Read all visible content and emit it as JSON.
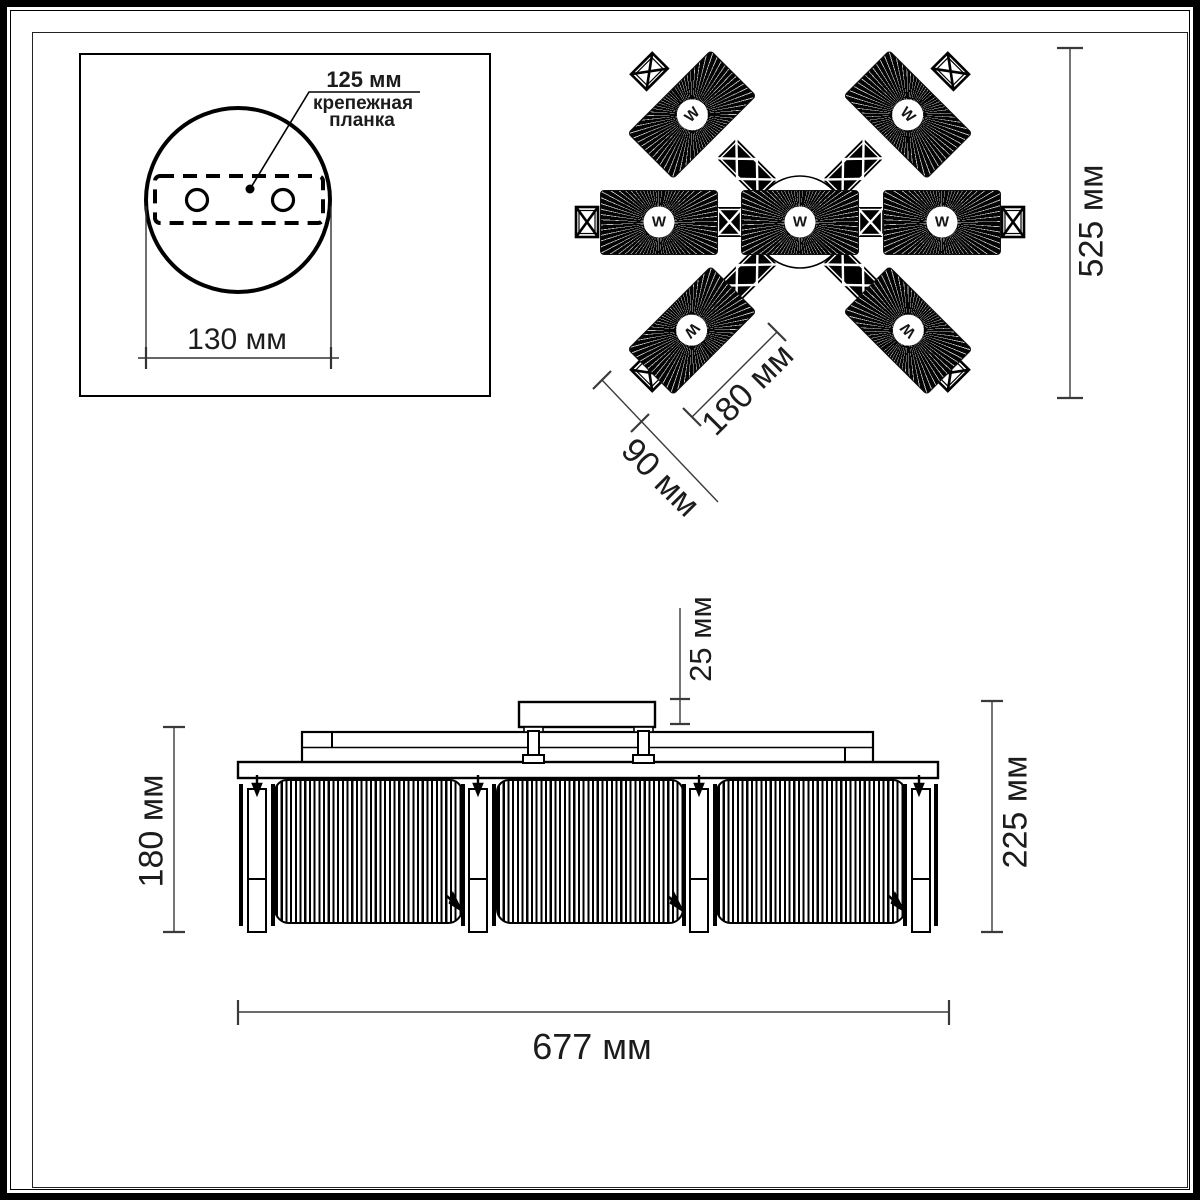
{
  "inset": {
    "plate_length_label": "125 мм",
    "plate_name_line1": "крепежная",
    "plate_name_line2": "планка",
    "base_diameter_label": "130 мм"
  },
  "top_view": {
    "bulb_symbol": "W",
    "overall_width_label": "525 мм",
    "shade_length_label": "180 мм",
    "shade_width_label": "90 мм"
  },
  "side_view": {
    "canopy_height_label": "25 мм",
    "shade_height_label": "180 мм",
    "total_height_label": "225 мм",
    "overall_width_label": "677 мм"
  }
}
